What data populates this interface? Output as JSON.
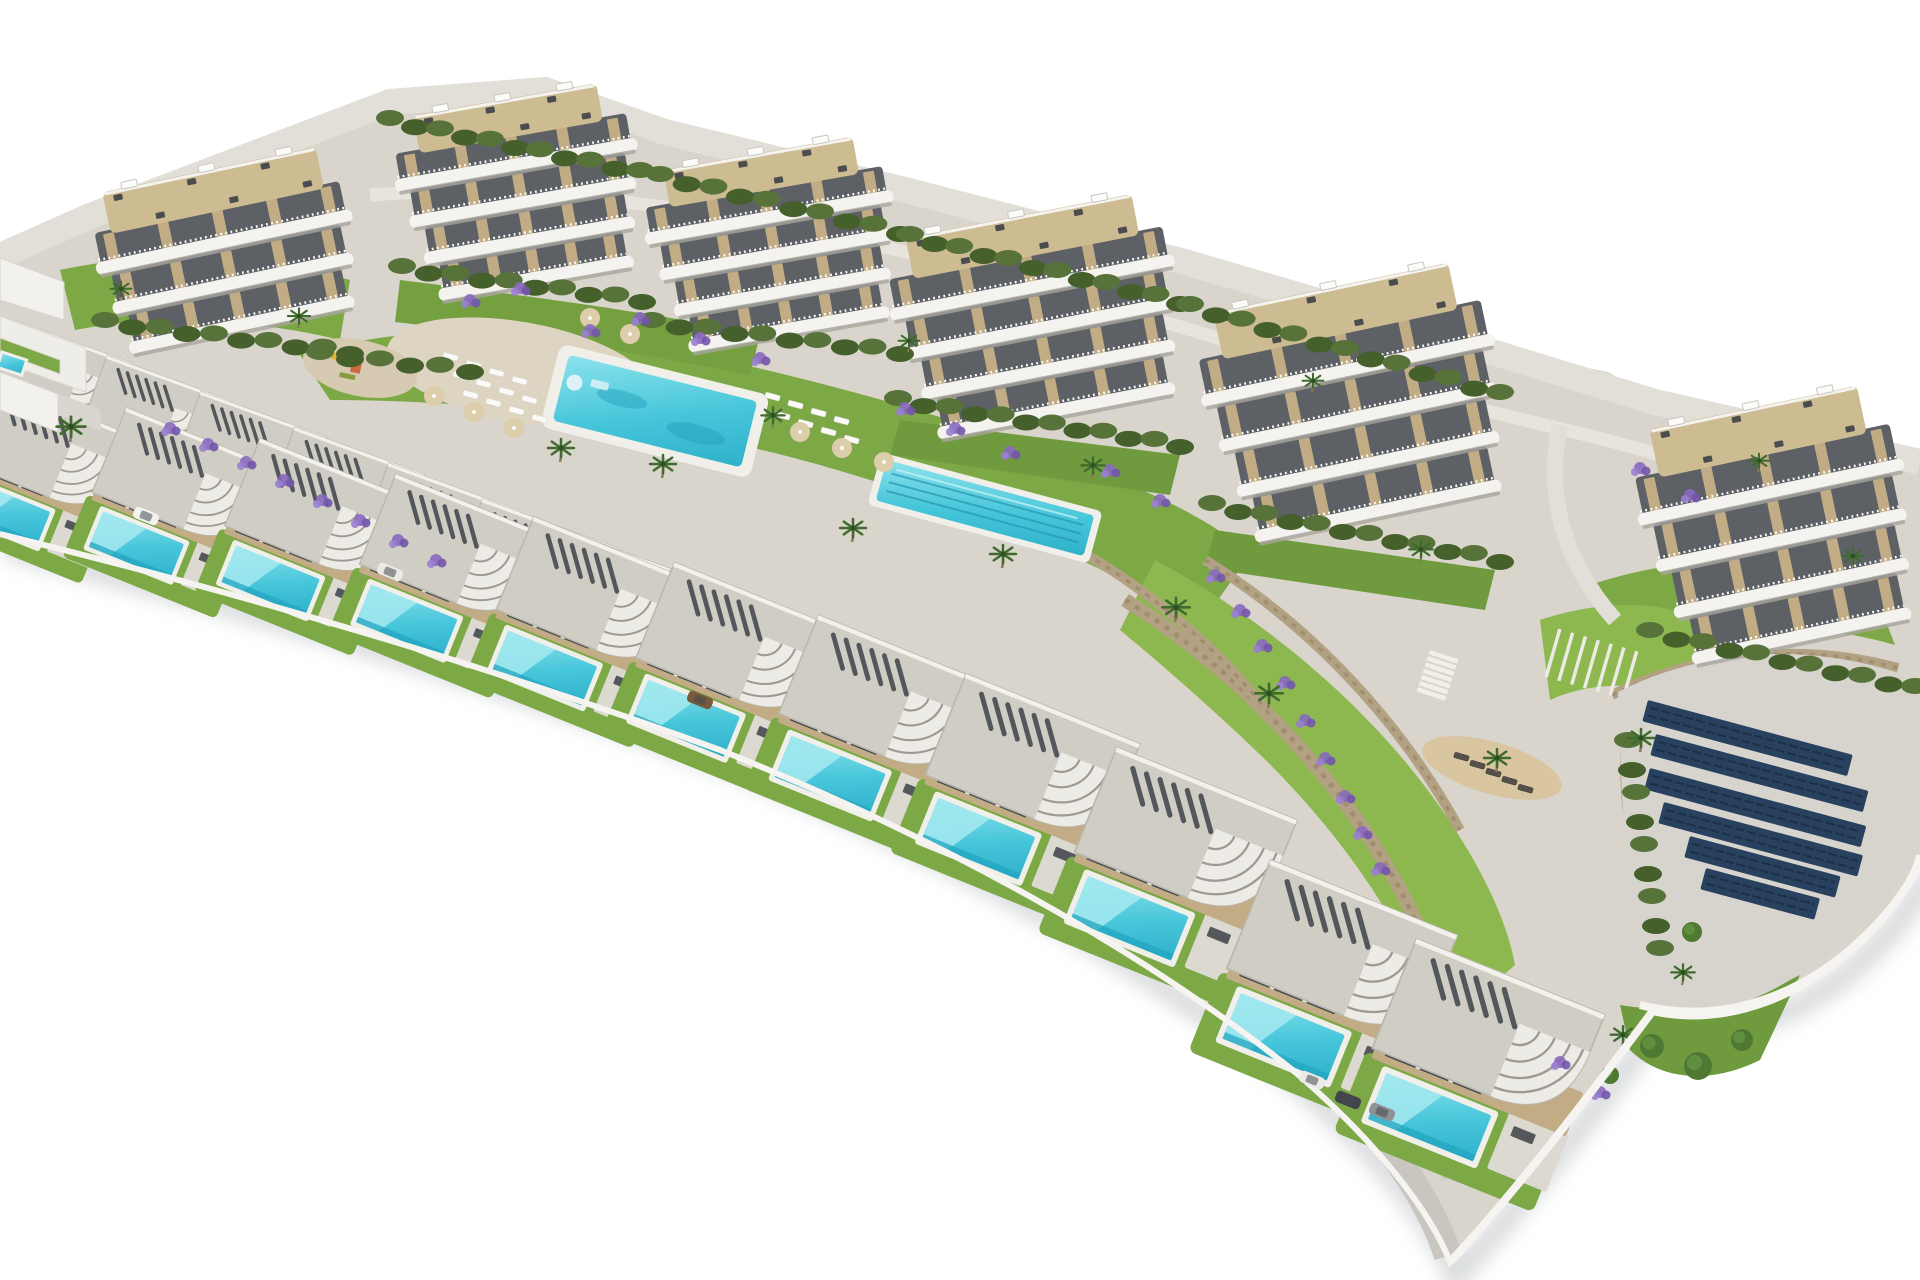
{
  "meta": {
    "alt": "Aerial 3D architectural render of a hillside residential development: six white curved-balcony apartment buildings along the top, a communal pool and lap pool on green lawns, rows of flat-roof villas with private pools descending to the lower right, a solar panel pad on the right, stone retaining walls, palm trees and lavender planting, all on a white background"
  },
  "palette": {
    "background": "#ffffff",
    "land": "#d9d5cc",
    "land_light": "#e2dfd8",
    "road": "#c9c6c0",
    "road_mid": "#ccc9c2",
    "road_top": "#e7e4dd",
    "plaza": "#ddd4c2",
    "pad": "#d7d4cd",
    "white_wall": "#f5f4f0",
    "shadow": "#8f969b",
    "lawn": "#7ca946",
    "lawn_light": "#8db84f",
    "lawn_dark": "#6f9a3e",
    "hedge_dark": "#45602b",
    "hedge_light": "#577339",
    "stone_wall": "#b3a184",
    "stone_dark": "#93825f",
    "pool_light": "#7fdde9",
    "pool_deep": "#2fb1cb",
    "pool_edge": "#23a5c0",
    "coping": "#f1efe9",
    "building_white": "#f4f3ef",
    "window_dark": "#5d6166",
    "tan_accent": "#c2ac85",
    "deck_beige": "#cdbb92",
    "roof_gravel": "#d0cdc5",
    "fascia": "#edebe5",
    "slat_dark": "#45494f",
    "terrace": "#dcd9d1",
    "glass": "#474b52",
    "furniture": "#3c4046",
    "lavender": "#8869be",
    "lavender_dark": "#7355ab",
    "lavender_light": "#9a7fd0",
    "palm_green": "#3f6b2f",
    "trunk": "#8a795b",
    "tree": "#4f7833",
    "solar_panel": "#28415f",
    "solar_line": "#1d3046",
    "sand": "#d9c5a0",
    "umbrella": "#dccdab",
    "mullion": "#e8e6e0"
  },
  "counts": {
    "apartment_buildings": 6,
    "villas": 20,
    "shared_pools": 2,
    "private_pools": 20,
    "solar_rows": 6
  },
  "land": {
    "outline": "M 0,252 L 90,212 L 390,98 L 545,86 L 665,128 L 905,186 L 1185,258 L 1505,352 L 1608,372 L 1655,398 L 1920,458 L 1920,858 C 1918,872 1908,890 1884,918 C 1810,1002 1724,1028 1652,1012 C 1586,1100 1512,1196 1450,1262 C 1428,1206 1370,1136 1295,1072 C 1140,948 940,838 720,750 C 500,670 260,598 0,534 Z",
    "edge": "M 0,534 C 260,598 500,670 720,750 C 940,838 1140,948 1295,1072 C 1370,1136 1428,1206 1450,1262 C 1512,1196 1586,1100 1652,1012 C 1724,1028 1810,1002 1884,918 C 1908,890 1918,872 1920,858",
    "top_rim": "M 0,256 L 90,216 L 390,102 L 545,90 L 665,132 L 905,190 L 1185,262 L 1505,356 L 1655,402 L 1920,462"
  },
  "roads": {
    "top": "M 370,195 C 640,175 950,255 1240,345 C 1420,400 1560,425 1660,455",
    "mid": "M 0,458 C 300,528 620,628 900,738 C 1100,826 1268,938 1378,1048 C 1420,1092 1444,1138 1452,1178",
    "front": "M 0,518 C 280,582 540,652 760,736 C 980,820 1160,928 1298,1050 C 1378,1122 1430,1198 1448,1256",
    "connector": "M 1560,425 C 1545,492 1562,560 1615,620",
    "walkway": "M 470,380 C 560,390 640,400 740,420"
  },
  "greens": [
    "M 300,355 C 420,320 560,325 700,355 C 840,385 1000,430 1130,485 C 1190,510 1230,535 1250,555 L 1200,625 C 1100,560 960,505 820,465 C 660,420 480,400 330,400 Z",
    "M 1155,560 C 1250,610 1350,690 1420,780 C 1470,845 1505,910 1515,965 L 1440,1030 C 1410,930 1340,830 1250,745 C 1195,693 1150,655 1120,630 Z",
    "M 1590,585 C 1680,555 1780,552 1870,580 L 1895,645 C 1800,618 1700,620 1615,650 Z",
    "M 900,420 L 1180,455 L 1170,495 L 890,455 Z",
    "M 1215,530 L 1495,570 L 1485,610 L 1205,568 Z",
    "M 60,270 C 150,250 260,255 350,280 L 340,340 C 250,318 150,315 75,330 Z",
    "M 400,280 C 520,295 640,310 760,335 L 750,375 C 630,350 510,335 395,322 Z",
    "M 1620,1005 C 1680,1015 1740,1005 1800,975 L 1760,1060 C 1710,1085 1660,1080 1630,1050 Z",
    "M 1540,620 C 1600,600 1660,600 1700,620 L 1690,700 C 1640,680 1590,682 1550,700 Z"
  ],
  "walls": [
    {
      "d": "M 140,418 C 260,455 380,505 470,552",
      "w": 12
    },
    {
      "d": "M 470,552 C 600,600 720,655 820,705",
      "w": 12
    },
    {
      "d": "M 1125,600 C 1230,665 1330,765 1395,880 C 1430,945 1450,1000 1455,1045",
      "w": 14
    },
    {
      "d": "M 1205,560 C 1310,625 1400,720 1460,830",
      "w": 10
    },
    {
      "d": "M 1612,695 C 1700,652 1800,642 1898,668",
      "w": 10
    },
    {
      "d": "M 1628,700 C 1620,780 1628,860 1655,930",
      "w": 10
    },
    {
      "d": "M 1075,548 C 1150,590 1220,650 1270,715",
      "w": 10
    }
  ],
  "white_walls": [
    "M 1640,1005 C 1720,1025 1810,1000 1885,915 C 1908,888 1918,868 1920,855",
    "M 1450,1262 C 1512,1196 1586,1100 1652,1012"
  ],
  "plaza": {
    "cx": 520,
    "cy": 372,
    "rx": 135,
    "ry": 50,
    "rot": 10
  },
  "playground": {
    "pad": {
      "cx": 360,
      "cy": 368,
      "rx": 58,
      "ry": 28,
      "rot": 12
    },
    "toys": [
      {
        "x": 332,
        "y": 352,
        "w": 14,
        "h": 7,
        "c": "#e2b33c"
      },
      {
        "x": 352,
        "y": 362,
        "w": 10,
        "h": 10,
        "c": "#cc6a43"
      },
      {
        "x": 372,
        "y": 352,
        "w": 9,
        "h": 9,
        "c": "#7fa7c7"
      },
      {
        "x": 340,
        "y": 372,
        "w": 16,
        "h": 5,
        "c": "#8a9a3f"
      }
    ]
  },
  "pool_main": {
    "cx": 655,
    "cy": 411,
    "w": 194,
    "h": 68,
    "rot": 14
  },
  "pool_lap": {
    "cx": 985,
    "cy": 508,
    "w": 215,
    "h": 42,
    "rot": 15,
    "lanes": 3
  },
  "loungers_white": {
    "rot": 15,
    "pts": [
      [
        444,
        352
      ],
      [
        467,
        360
      ],
      [
        490,
        368
      ],
      [
        513,
        376
      ],
      [
        454,
        371
      ],
      [
        477,
        379
      ],
      [
        500,
        387
      ],
      [
        523,
        395
      ],
      [
        464,
        390
      ],
      [
        487,
        398
      ],
      [
        510,
        406
      ],
      [
        533,
        414
      ],
      [
        766,
        392
      ],
      [
        789,
        400
      ],
      [
        812,
        408
      ],
      [
        835,
        416
      ],
      [
        776,
        411
      ],
      [
        799,
        419
      ],
      [
        822,
        427
      ],
      [
        845,
        435
      ]
    ]
  },
  "loungers_dark": {
    "rot": 16,
    "pts": [
      [
        1455,
        752
      ],
      [
        1471,
        760
      ],
      [
        1487,
        768
      ],
      [
        1503,
        776
      ],
      [
        1519,
        784
      ]
    ]
  },
  "umbrellas": [
    [
      434,
      396
    ],
    [
      474,
      412
    ],
    [
      514,
      428
    ],
    [
      800,
      432
    ],
    [
      842,
      448
    ],
    [
      884,
      462
    ],
    [
      590,
      318
    ],
    [
      630,
      334
    ]
  ],
  "sand": {
    "cx": 1492,
    "cy": 768,
    "rx": 72,
    "ry": 26,
    "rot": 16
  },
  "pergola": {
    "x": 1556,
    "y": 628,
    "w": 88,
    "h": 50,
    "rot": 16,
    "slats": 7
  },
  "stairs": {
    "x": 1430,
    "y": 650,
    "w": 30,
    "h": 4.5,
    "dy": 6.5,
    "rot": 18,
    "steps": 7
  },
  "solar": {
    "pad": "M 1618,692 C 1700,650 1800,642 1896,672 L 1920,700 L 1920,852 C 1900,884 1868,920 1830,952 C 1760,1008 1700,1020 1660,1008 C 1640,996 1630,968 1628,930 C 1625,848 1620,764 1618,692 Z",
    "rot": 15,
    "row_h": 22,
    "rows": [
      [
        1648,
        700,
        212
      ],
      [
        1656,
        734,
        220
      ],
      [
        1650,
        768,
        224
      ],
      [
        1664,
        802,
        206
      ],
      [
        1690,
        836,
        156
      ],
      [
        1706,
        868,
        118
      ]
    ]
  },
  "buildings": [
    {
      "x": 95,
      "y": 168,
      "w": 262,
      "h": 165,
      "rot": -12,
      "floors": 3
    },
    {
      "x": 398,
      "y": 98,
      "w": 246,
      "h": 188,
      "rot": -10,
      "floors": 4
    },
    {
      "x": 648,
      "y": 152,
      "w": 252,
      "h": 185,
      "rot": -10,
      "floors": 4
    },
    {
      "x": 893,
      "y": 214,
      "w": 290,
      "h": 205,
      "rot": -11,
      "floors": 4
    },
    {
      "x": 1205,
      "y": 285,
      "w": 300,
      "h": 235,
      "rot": -12,
      "floors": 4
    },
    {
      "x": 1642,
      "y": 405,
      "w": 272,
      "h": 240,
      "rot": -12,
      "floors": 4
    }
  ],
  "villas": {
    "back": {
      "rot": 20,
      "items": [
        [
          18,
          328,
          0.74
        ],
        [
          112,
          364,
          0.76
        ],
        [
          206,
          400,
          0.78
        ],
        [
          300,
          436,
          0.8
        ],
        [
          394,
          472,
          0.82
        ],
        [
          488,
          508,
          0.84
        ],
        [
          582,
          544,
          0.86
        ],
        [
          676,
          580,
          0.88
        ],
        [
          770,
          616,
          0.9
        ]
      ]
    },
    "front": {
      "rot": 22,
      "items": [
        [
          0,
          390,
          0.88
        ],
        [
          132,
          418,
          0.91
        ],
        [
          266,
          449,
          0.94
        ],
        [
          402,
          485,
          0.97
        ],
        [
          540,
          528,
          1.0
        ],
        [
          681,
          574,
          1.03
        ],
        [
          825,
          627,
          1.06
        ],
        [
          973,
          686,
          1.09
        ],
        [
          1124,
          760,
          1.13
        ],
        [
          1278,
          873,
          1.17
        ],
        [
          1424,
          952,
          1.18
        ]
      ]
    }
  },
  "left_structures": [
    {
      "pts": "0,258 64,282 64,320 0,300",
      "fill": "#f2f1ed"
    },
    {
      "pts": "0,316 86,348 86,392 0,362",
      "fill": "#eeede8"
    },
    {
      "pts": "0,372 58,394 58,432 0,410",
      "fill": "#f2f1ed"
    },
    {
      "pts": "58,394 100,410 100,430 58,414",
      "fill": "#d9d6cf"
    },
    {
      "pts": "0,338 60,360 60,374 0,352",
      "fill": "#7ca946"
    }
  ],
  "left_pool": {
    "x": 2,
    "y": 352,
    "w": 26,
    "h": 16,
    "rot": 18
  },
  "hedge_chains": [
    [
      105,
      322,
      350,
      352
    ],
    [
      402,
      268,
      642,
      300
    ],
    [
      652,
      322,
      900,
      352
    ],
    [
      898,
      400,
      1180,
      445
    ],
    [
      1212,
      505,
      1500,
      560
    ],
    [
      1650,
      632,
      1915,
      688
    ],
    [
      390,
      120,
      640,
      172
    ],
    [
      660,
      176,
      900,
      232
    ],
    [
      910,
      236,
      1180,
      302
    ],
    [
      1190,
      306,
      1500,
      394
    ],
    [
      320,
      354,
      470,
      370
    ],
    [
      1628,
      742,
      1660,
      950
    ]
  ],
  "lavender": [
    [
      170,
      428
    ],
    [
      208,
      444
    ],
    [
      246,
      462
    ],
    [
      284,
      480
    ],
    [
      322,
      500
    ],
    [
      360,
      520
    ],
    [
      398,
      540
    ],
    [
      436,
      560
    ],
    [
      590,
      330
    ],
    [
      640,
      318
    ],
    [
      700,
      338
    ],
    [
      760,
      358
    ],
    [
      1110,
      470
    ],
    [
      1160,
      500
    ],
    [
      1215,
      575
    ],
    [
      1240,
      610
    ],
    [
      1262,
      645
    ],
    [
      1285,
      682
    ],
    [
      1305,
      720
    ],
    [
      1325,
      758
    ],
    [
      1345,
      796
    ],
    [
      1362,
      832
    ],
    [
      1380,
      868
    ],
    [
      1560,
      1062
    ],
    [
      1600,
      1092
    ],
    [
      1640,
      468
    ],
    [
      1690,
      495
    ],
    [
      470,
      300
    ],
    [
      520,
      288
    ],
    [
      905,
      408
    ],
    [
      955,
      428
    ],
    [
      1010,
      452
    ]
  ],
  "palms": [
    [
      70,
      442,
      1.1
    ],
    [
      298,
      328,
      0.85
    ],
    [
      560,
      462,
      1.0
    ],
    [
      662,
      478,
      1.0
    ],
    [
      772,
      428,
      0.9
    ],
    [
      852,
      542,
      1.0
    ],
    [
      1002,
      568,
      1.0
    ],
    [
      1092,
      478,
      0.9
    ],
    [
      1175,
      622,
      1.05
    ],
    [
      1268,
      708,
      1.05
    ],
    [
      1420,
      562,
      0.9
    ],
    [
      1496,
      772,
      1.0
    ],
    [
      1640,
      752,
      1.0
    ],
    [
      1758,
      472,
      0.8
    ],
    [
      1852,
      568,
      0.85
    ],
    [
      1622,
      1048,
      0.95
    ],
    [
      1682,
      985,
      0.9
    ],
    [
      908,
      352,
      0.8
    ],
    [
      1312,
      392,
      0.8
    ],
    [
      120,
      300,
      0.8
    ]
  ],
  "trees": [
    [
      1652,
      1046,
      12
    ],
    [
      1698,
      1066,
      14
    ],
    [
      1742,
      1040,
      11
    ],
    [
      1692,
      932,
      10
    ],
    [
      1610,
      1075,
      9
    ]
  ],
  "cars": {
    "rot": 22,
    "items": [
      [
        146,
        516,
        "#f3f2ef"
      ],
      [
        390,
        572,
        "#ebe9e4"
      ],
      [
        700,
        700,
        "#7a5a3c"
      ],
      [
        1312,
        1080,
        "#eceae6"
      ],
      [
        1348,
        1100,
        "#41454b"
      ],
      [
        1382,
        1112,
        "#8f9295"
      ]
    ]
  }
}
